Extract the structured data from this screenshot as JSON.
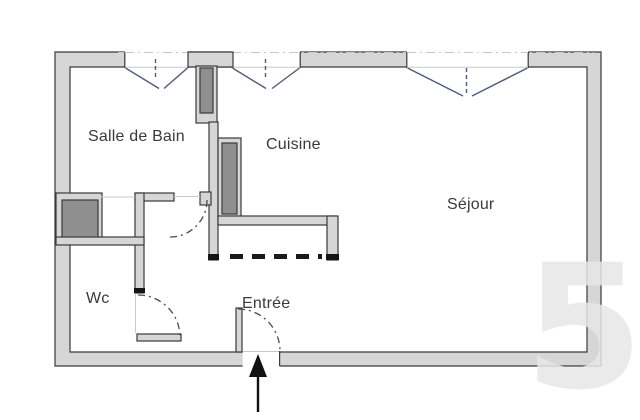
{
  "plan": {
    "rooms": [
      {
        "id": "salle-de-bain",
        "label": "Salle de Bain"
      },
      {
        "id": "cuisine",
        "label": "Cuisine"
      },
      {
        "id": "sejour",
        "label": "Séjour"
      },
      {
        "id": "wc",
        "label": "Wc"
      },
      {
        "id": "entree",
        "label": "Entrée"
      }
    ],
    "watermark": {
      "text": "5"
    },
    "colors": {
      "background": "#ffffff",
      "wall_fill": "#d6d6d6",
      "wall_outline": "#3a3a3a",
      "duct_fill": "#8f8f8f",
      "window_line": "#4d5a7d",
      "door_arc": "#4a4a4a",
      "dash_line": "#1a1a1a",
      "label_text": "#3a3a3a",
      "watermark": "#e7e7e7"
    }
  }
}
